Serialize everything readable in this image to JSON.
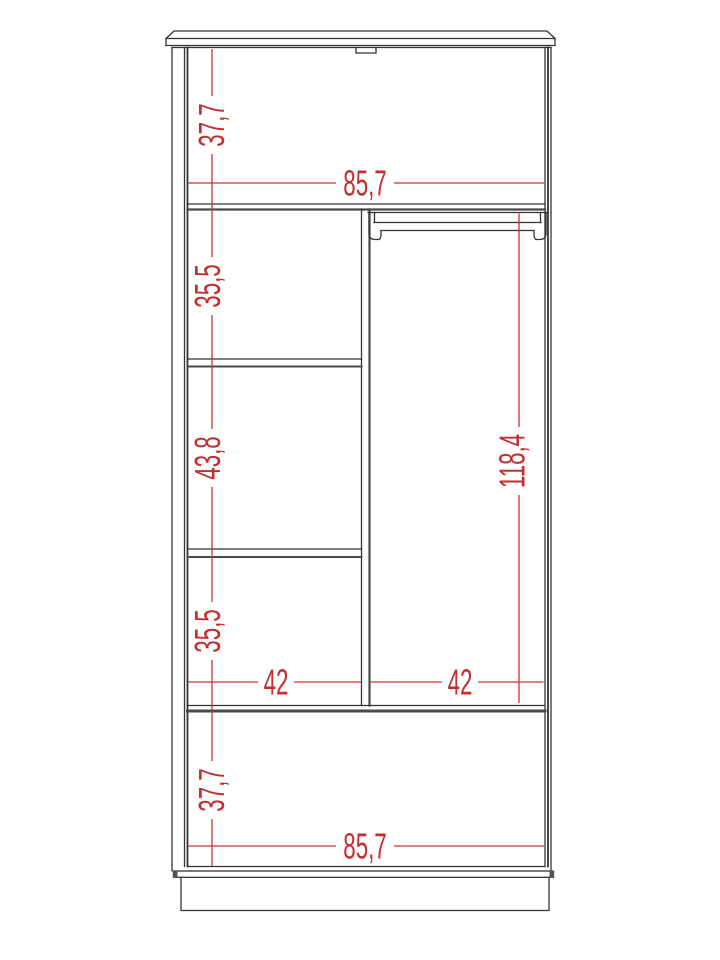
{
  "drawing": {
    "kind": "wardrobe-front-elevation-technical-drawing",
    "colors": {
      "outline": "#333333",
      "outline_thick": "#4a4a4a",
      "dimension_red": "#c73434",
      "background": "#ffffff"
    }
  },
  "dims": {
    "v_top_left": "37,7",
    "h_top": "85,7",
    "v_upper_shelf": "35,5",
    "v_middle_shelf": "43,8",
    "v_lower_shelf": "35,5",
    "v_right_section": "118,4",
    "h_left_compartment": "42",
    "h_right_compartment": "42",
    "v_bottom_left": "37,7",
    "h_bottom": "85,7"
  }
}
